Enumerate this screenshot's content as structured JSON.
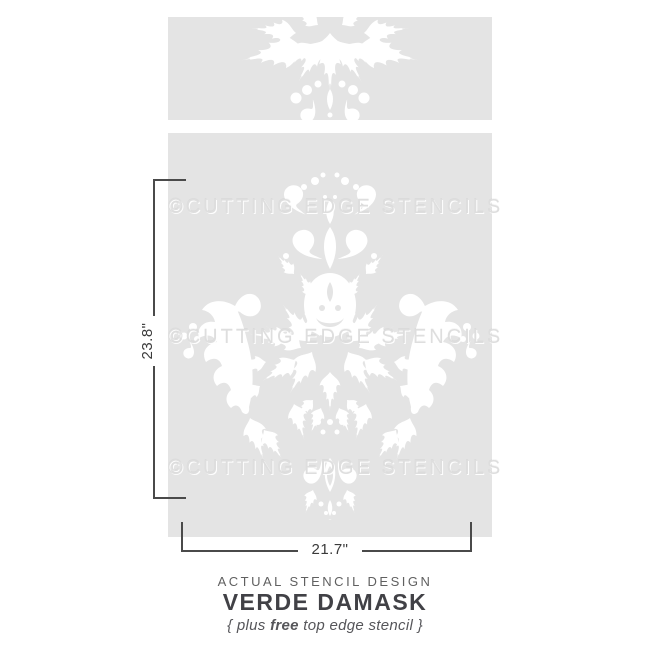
{
  "stencil": {
    "watermark": "©CUTTING EDGE STENCILS",
    "panel_color": "#e4e4e4",
    "pattern_color": "#ffffff",
    "dimension_line_color": "#4a4a4a"
  },
  "dimensions": {
    "height": "23.8\"",
    "width": "21.7\""
  },
  "caption": {
    "tagline": "ACTUAL STENCIL DESIGN",
    "title": "VERDE DAMASK",
    "note_open": "{ plus ",
    "note_bold": "free",
    "note_close": " top edge stencil }"
  }
}
